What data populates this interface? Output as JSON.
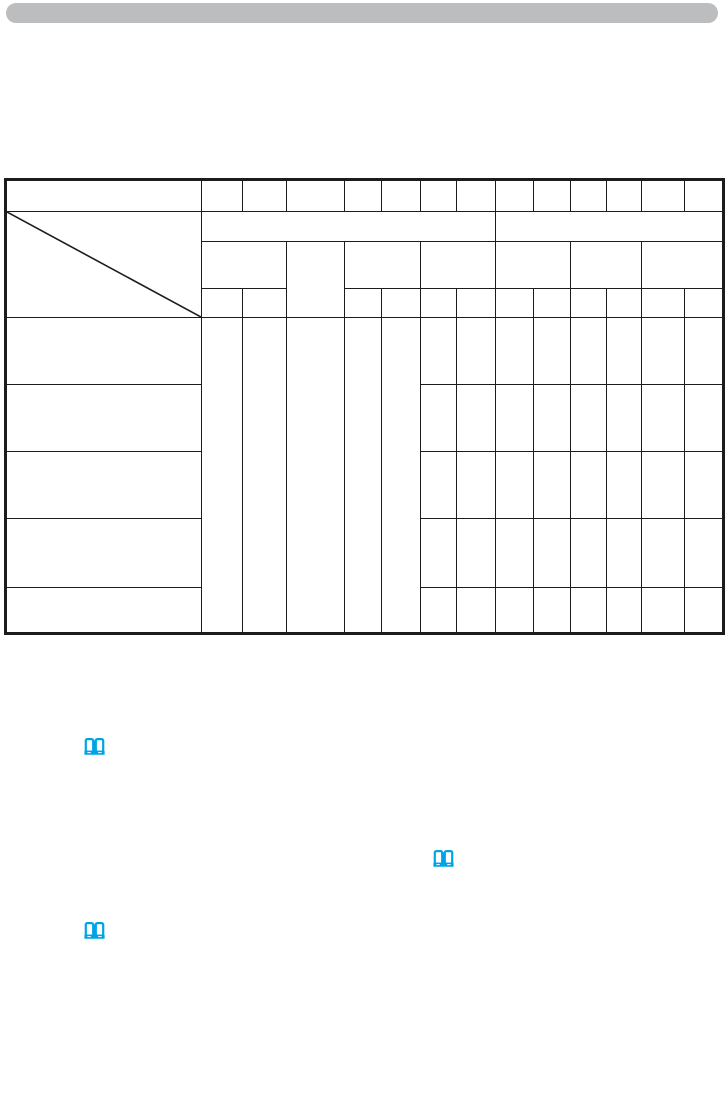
{
  "page": {
    "kind": "blank manual page (all text removed)",
    "background_color": "#ffffff"
  },
  "header_bar": {
    "shape": "rounded-bar",
    "fill_color": "#bbbdbf"
  },
  "table": {
    "line_color": "#1c1c1c",
    "content": "all cells blank",
    "top_row_cell_count": 14,
    "header_group_cells": 2,
    "body_row_count": 5,
    "has_diagonal_header_cell": true
  },
  "icons": {
    "open_book": {
      "name": "open-book-icon",
      "color": "#00a4e4",
      "occurrences": 3
    }
  }
}
